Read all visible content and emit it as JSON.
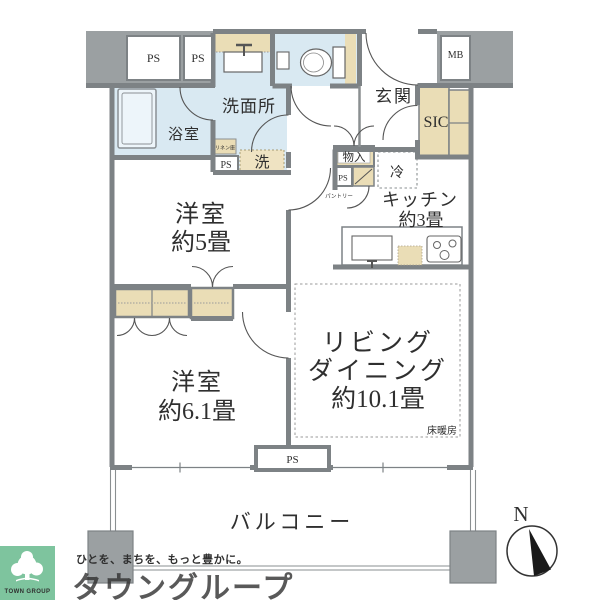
{
  "floorplan": {
    "rooms": {
      "washroom": "洗面所",
      "bathroom": "浴室",
      "entrance": "玄関",
      "shoe_closet": "SIC",
      "kitchen_name": "キッチン",
      "kitchen_size": "約3畳",
      "bedroom5_name": "洋室",
      "bedroom5_size": "約5畳",
      "bedroom61_name": "洋室",
      "bedroom61_size": "約6.1畳",
      "living_name1": "リビング",
      "living_name2": "ダイニング",
      "living_size": "約10.1畳",
      "balcony": "バルコニー"
    },
    "fixtures": {
      "ps": "PS",
      "mb": "MB",
      "washer": "洗",
      "fridge": "冷",
      "storage": "物入",
      "pantry": "パントリー",
      "linen": "リネン庫",
      "floor_heating": "床暖房"
    },
    "compass": {
      "north": "N"
    }
  },
  "branding": {
    "logo_text": "TOWN GROUP",
    "tagline": "ひとを、まちを、もっと豊かに。",
    "company": "タウングループ"
  },
  "palette": {
    "wall": "#7d8285",
    "gray_fill": "#9ba0a2",
    "wet_area": "#d9e9f2",
    "closet_tan": "#eaddb6",
    "brand_green": "#46b180",
    "logo_bg_green": "#7ec49e"
  }
}
